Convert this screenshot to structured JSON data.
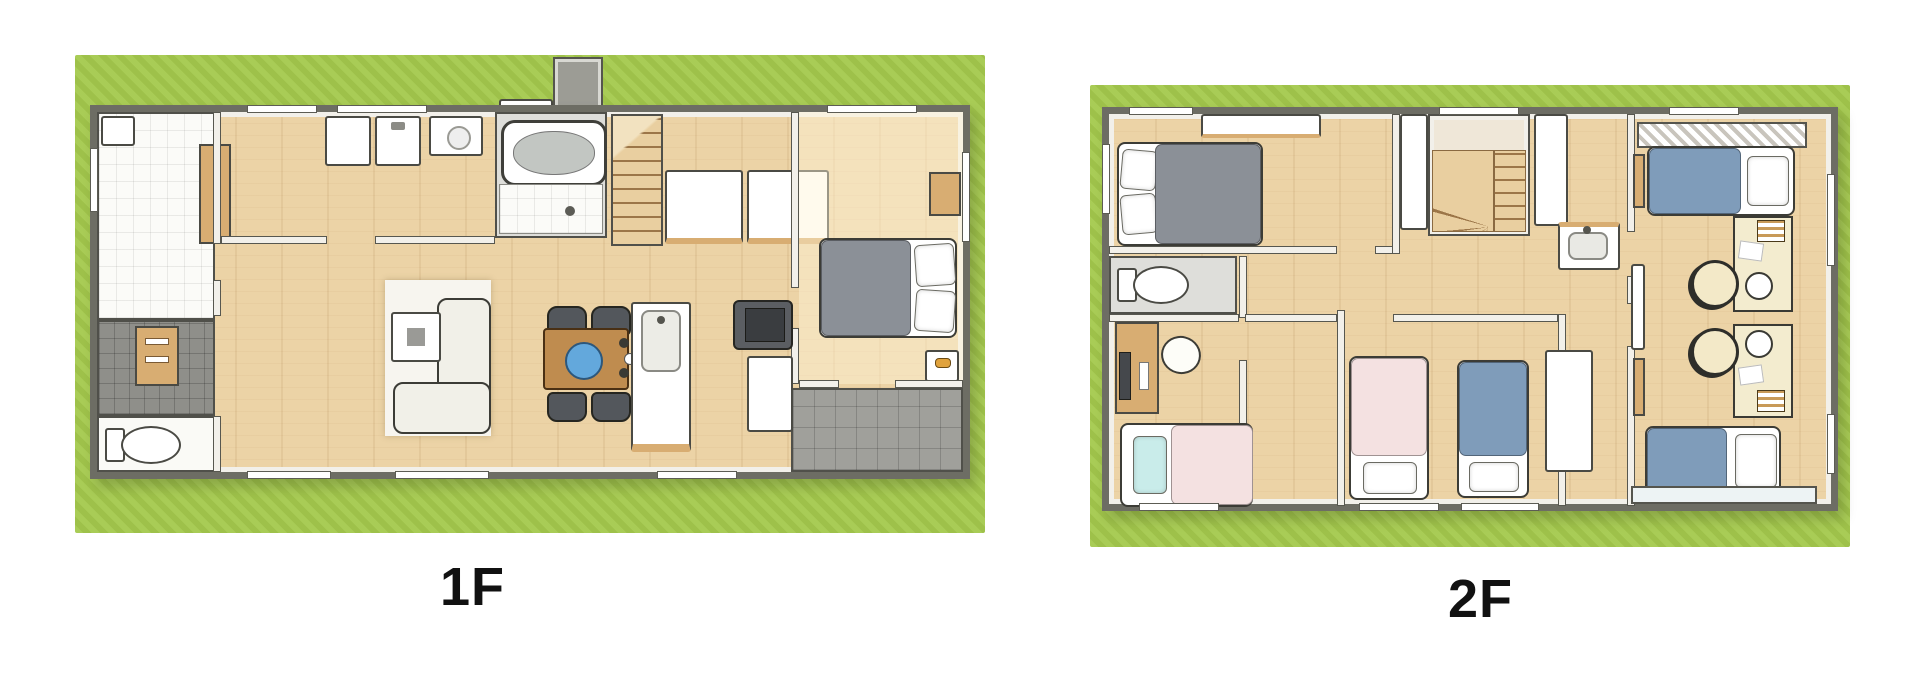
{
  "page": {
    "background": "#ffffff"
  },
  "floors": [
    {
      "id": "floor-1",
      "label": "1F"
    },
    {
      "id": "floor-2",
      "label": "2F"
    }
  ],
  "colors": {
    "background": "#ffffff",
    "grass": "#a4c94d",
    "wall_outline": "#6d6d64",
    "wall_face": "#f2f0ea",
    "wood_floor": "#ecd3a6",
    "wood_trim": "#d8ad72",
    "tile_white": "#fbfbf8",
    "entrance_grey": "#8f8f8a",
    "terrace_grey": "#a0a09b",
    "bath_grey": "#dededa",
    "bed_grey": "#8b9097",
    "bed_blue": "#7f9cba",
    "bed_pink": "#f4e1e1",
    "pillow_cyan": "#c9ecea",
    "table_wood": "#bf8c4f",
    "chair_dark": "#53575c",
    "plate_blue": "#63a8dc",
    "sofa_cream": "#f1f0e8",
    "desk_cream": "#f3eccf",
    "label_color": "#111111"
  }
}
